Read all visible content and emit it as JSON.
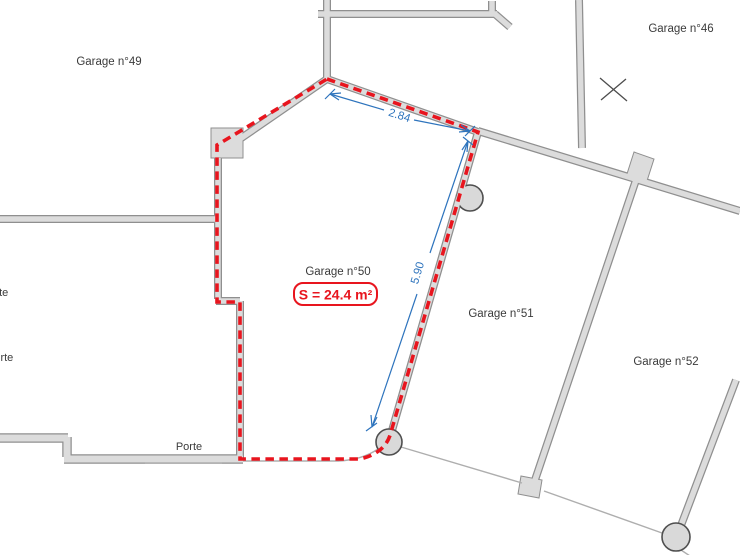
{
  "plan_type": "floor-plan",
  "colors": {
    "wall_fill": "#dcdcdc",
    "wall_outline": "#8f8f8f",
    "boundary_red": "#e8151e",
    "dimension_blue": "#2e74bd",
    "label_gray": "#3b3b3b"
  },
  "rooms": {
    "garage49": {
      "label": "Garage n°49"
    },
    "garage46": {
      "label": "Garage n°46"
    },
    "garage50": {
      "label": "Garage n°50"
    },
    "garage51": {
      "label": "Garage n°51"
    },
    "garage52": {
      "label": "Garage n°52"
    }
  },
  "doors": {
    "bottom": {
      "label": "Porte"
    },
    "left_upper": {
      "label": "Porte"
    },
    "left_lower": {
      "label": "Porte"
    }
  },
  "highlight": {
    "room": "Garage n°50",
    "area_label": "S = 24.4 m²",
    "area_value": 24.4,
    "area_unit": "m²"
  },
  "dimensions": {
    "top": {
      "label": "2.84",
      "value": 2.84,
      "unit": "m"
    },
    "side": {
      "label": "5.90",
      "value": 5.9,
      "unit": "m"
    }
  }
}
